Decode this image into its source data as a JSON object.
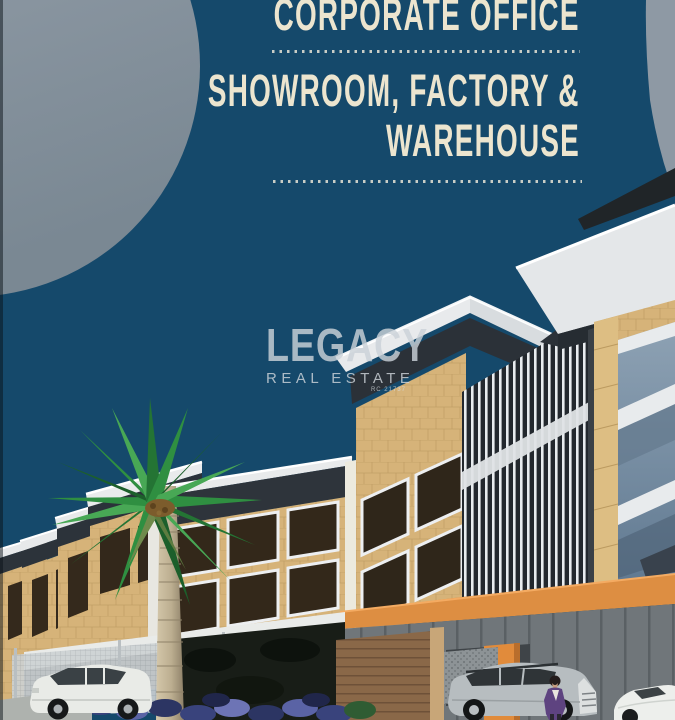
{
  "poster": {
    "heading": {
      "line1": "CORPORATE OFFICE",
      "line2": "SHOWROOM, FACTORY &",
      "line3": "WAREHOUSE"
    },
    "watermark": {
      "brand": "LEGACY",
      "subtitle": "REAL ESTATE",
      "registration": "RC 21737"
    },
    "colors": {
      "background_navy": "#15496b",
      "circle_gray": "#8793a0",
      "heading_cream": "#ece5cf",
      "divider_dot": "#c9cdc6",
      "roof_white": "#e6e8ea",
      "fascia_dark": "#2b3138",
      "wood_tan": "#d6b379",
      "accent_orange": "#dd8e42",
      "glass_blue": "#7e93a6",
      "watermark_gray": "#cbd2d8",
      "palm_green": "#2f8f41"
    }
  }
}
